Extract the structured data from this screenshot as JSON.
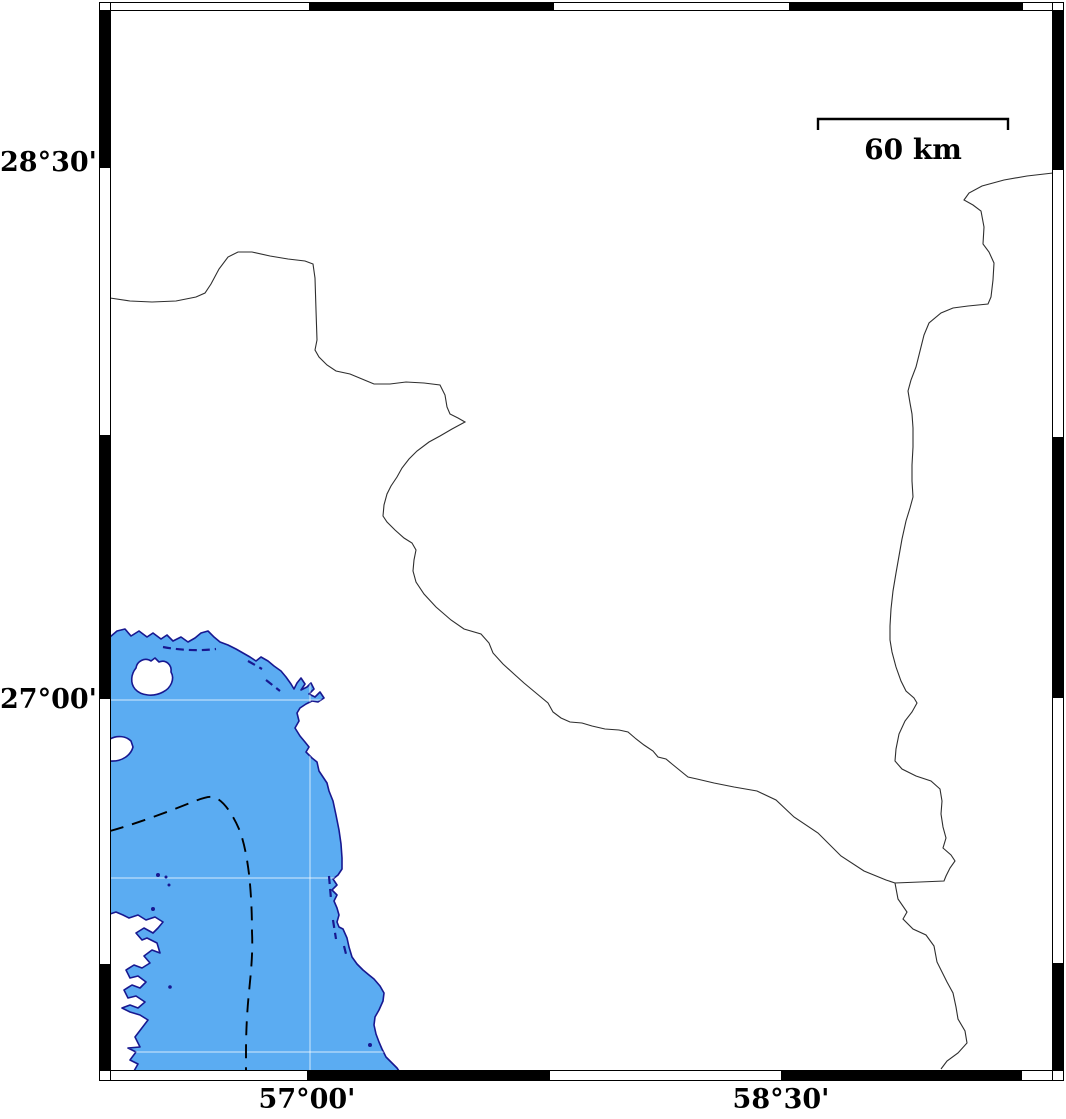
{
  "map": {
    "type": "geographic-map",
    "description": "Coastal map with fancy alternating black/white frame, sea at lower left, dashed depth contour and thin administrative boundary lines",
    "axis_labels": {
      "lat_upper": "28°30'",
      "lat_lower": "27°00'",
      "lon_left": "57°00'",
      "lon_right": "58°30'"
    },
    "scale_bar": {
      "label": "60 km"
    },
    "colors": {
      "sea_fill": "#5BACF2",
      "coastline": "#181890",
      "land_fill": "#FFFFFF",
      "frame": "#000000",
      "depth_contour": "#000000",
      "admin_boundary": "#2E2E2E",
      "graticule": "rgba(255,255,255,0.6)"
    }
  }
}
